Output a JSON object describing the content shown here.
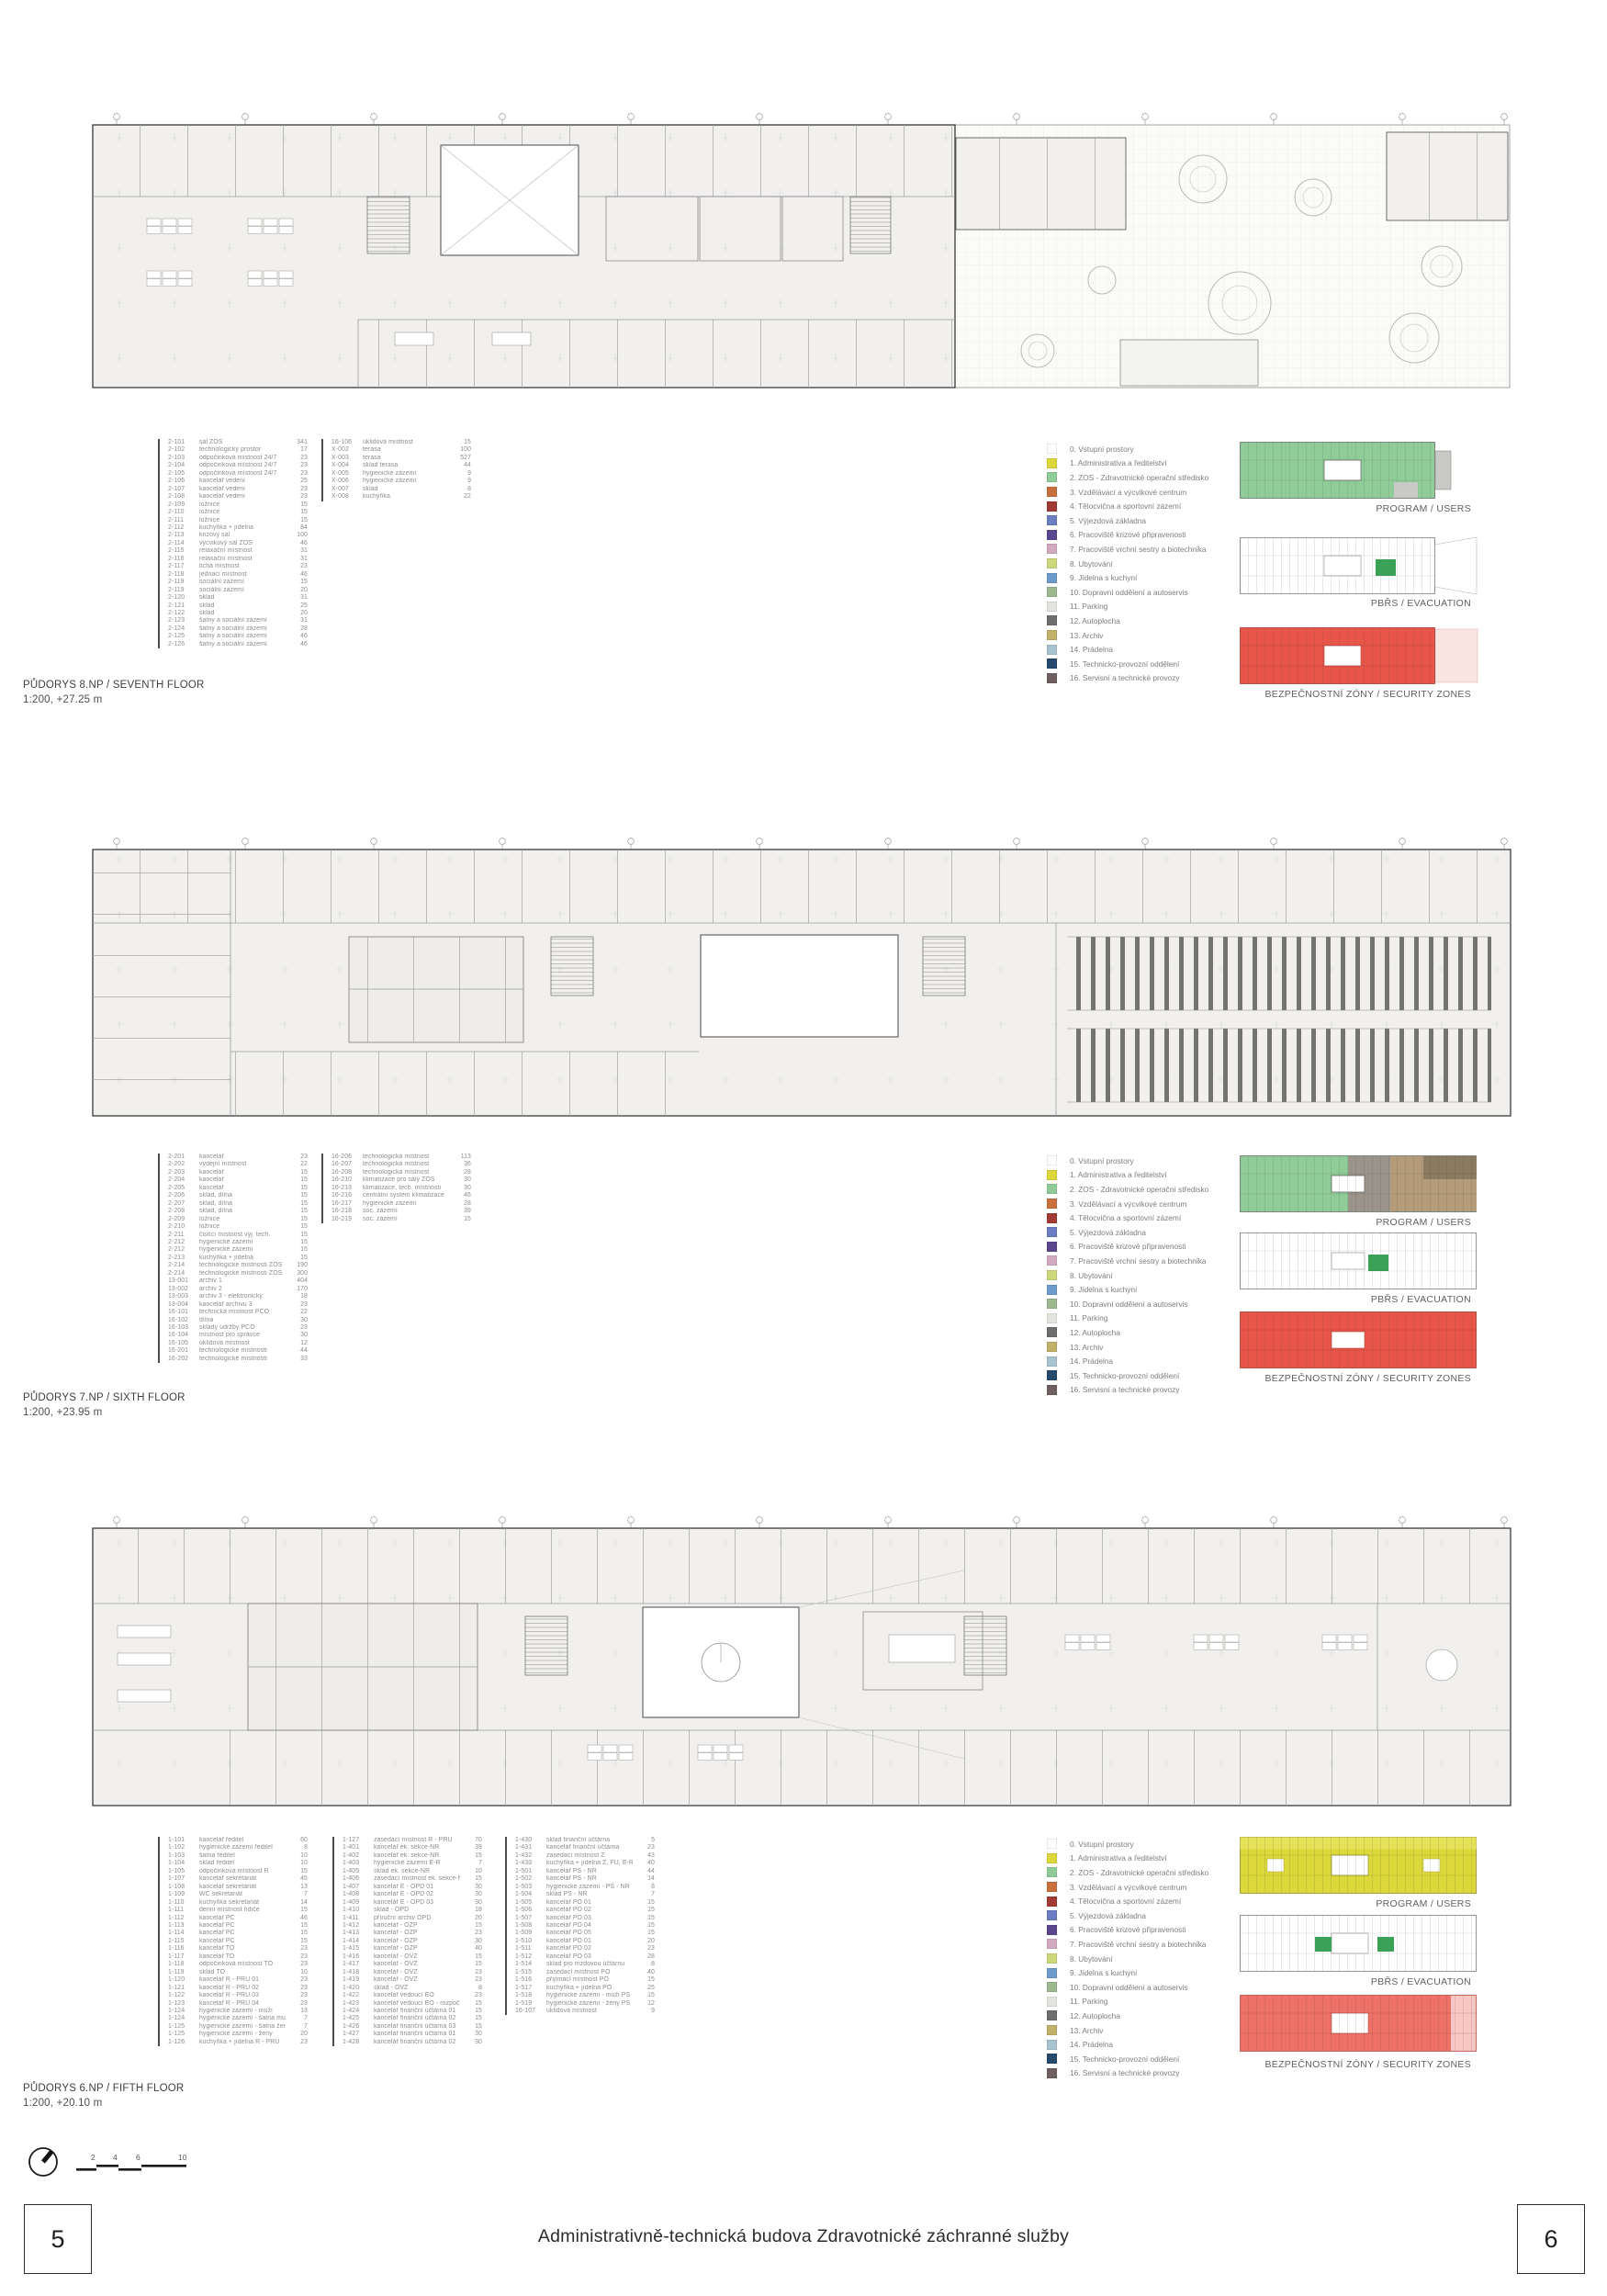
{
  "sheet": {
    "title": "Administrativně-technická budova Zdravotnické záchranné služby",
    "page_left": "5",
    "page_right": "6"
  },
  "diagram_labels": {
    "program": "PROGRAM / USERS",
    "evacuation": "PBŘS / EVACUATION",
    "security": "BEZPEČNOSTNÍ ZÓNY / SECURITY ZONES"
  },
  "scalebar": {
    "ticks": [
      "2",
      "4",
      "6",
      "10"
    ]
  },
  "legend": {
    "items": [
      {
        "label": "0. Vstupní prostory",
        "color": "#ffffff"
      },
      {
        "label": "1. Administrativa a ředitelství",
        "color": "#dcd83b"
      },
      {
        "label": "2. ZOS - Zdravotnické operační středisko",
        "color": "#90cc98"
      },
      {
        "label": "3. Vzdělávací a výcvikové centrum",
        "color": "#c8713d"
      },
      {
        "label": "4. Tělocvična a sportovní zázemí",
        "color": "#a23a36"
      },
      {
        "label": "5. Výjezdová základna",
        "color": "#6b7ec4"
      },
      {
        "label": "6. Pracoviště krizové připravenosti",
        "color": "#59478f"
      },
      {
        "label": "7. Pracoviště vrchní sestry a biotechnika",
        "color": "#d2aabe"
      },
      {
        "label": "8. Ubytování",
        "color": "#cdd77c"
      },
      {
        "label": "9. Jídelna s kuchyní",
        "color": "#6f9bcc"
      },
      {
        "label": "10. Dopravní oddělení a autoservis",
        "color": "#9db88f"
      },
      {
        "label": "11. Parking",
        "color": "#e4e4e0"
      },
      {
        "label": "12. Autoplocha",
        "color": "#6e6e6e"
      },
      {
        "label": "13. Archiv",
        "color": "#c2b169"
      },
      {
        "label": "14. Prádelna",
        "color": "#a7c3cf"
      },
      {
        "label": "15. Technicko-provozní oddělení",
        "color": "#27496d"
      },
      {
        "label": "16. Servisní a technické provozy",
        "color": "#6f5f60"
      }
    ]
  },
  "floors": [
    {
      "id": "8np",
      "title": "PŮDORYS 8.NP / SEVENTH FLOOR",
      "subtitle": "1:200, +27.25 m",
      "rooms_col1": [
        [
          "2-101",
          "sál ZOS",
          "341"
        ],
        [
          "2-102",
          "technologický prostor",
          "17"
        ],
        [
          "2-103",
          "odpočinková místnost 24/7",
          "23"
        ],
        [
          "2-104",
          "odpočinková místnost 24/7",
          "23"
        ],
        [
          "2-105",
          "odpočinková místnost 24/7",
          "23"
        ],
        [
          "2-106",
          "kancelář vedení",
          "25"
        ],
        [
          "2-107",
          "kancelář vedení",
          "23"
        ],
        [
          "2-108",
          "kancelář vedení",
          "23"
        ],
        [
          "2-109",
          "ložnice",
          "15"
        ],
        [
          "2-110",
          "ložnice",
          "15"
        ],
        [
          "2-111",
          "ložnice",
          "15"
        ],
        [
          "2-112",
          "kuchyňka + jídelna",
          "84"
        ],
        [
          "2-113",
          "krizový sál",
          "100"
        ],
        [
          "2-114",
          "výcvikový sál ZOS",
          "46"
        ],
        [
          "2-115",
          "relaxační místnost",
          "31"
        ],
        [
          "2-116",
          "relaxační místnost",
          "31"
        ],
        [
          "2-117",
          "tichá místnost",
          "23"
        ],
        [
          "2-118",
          "jednací místnost",
          "46"
        ],
        [
          "2-119",
          "sociální zázemí",
          "15"
        ],
        [
          "2-119",
          "sociální zázemí",
          "20"
        ],
        [
          "2-120",
          "sklad",
          "31"
        ],
        [
          "2-121",
          "sklad",
          "25"
        ],
        [
          "2-122",
          "sklad",
          "20"
        ],
        [
          "2-123",
          "šatny a sociální zázemí",
          "31"
        ],
        [
          "2-124",
          "šatny a sociální zázemí",
          "28"
        ],
        [
          "2-125",
          "šatny a sociální zázemí",
          "46"
        ],
        [
          "2-126",
          "šatny a sociální zázemí",
          "46"
        ]
      ],
      "rooms_col2": [
        [
          "16-106",
          "úklidová místnost",
          "15"
        ],
        [
          "X-002",
          "terasa",
          "100"
        ],
        [
          "X-003",
          "terasa",
          "527"
        ],
        [
          "X-004",
          "sklad terasa",
          "44"
        ],
        [
          "X-005",
          "hygienické zázemí",
          "9"
        ],
        [
          "X-006",
          "hygienické zázemí",
          "9"
        ],
        [
          "X-007",
          "sklad",
          "8"
        ],
        [
          "X-008",
          "kuchyňka",
          "22"
        ]
      ]
    },
    {
      "id": "7np",
      "title": "PŮDORYS 7.NP / SIXTH FLOOR",
      "subtitle": "1:200, +23.95 m",
      "rooms_col1": [
        [
          "2-201",
          "kancelář",
          "23"
        ],
        [
          "2-202",
          "výdejní místnost",
          "22"
        ],
        [
          "2-203",
          "kancelář",
          "15"
        ],
        [
          "2-204",
          "kancelář",
          "15"
        ],
        [
          "2-205",
          "kancelář",
          "15"
        ],
        [
          "2-206",
          "sklad, dílna",
          "15"
        ],
        [
          "2-207",
          "sklad, dílna",
          "15"
        ],
        [
          "2-208",
          "sklad, dílna",
          "15"
        ],
        [
          "2-209",
          "ložnice",
          "15"
        ],
        [
          "2-210",
          "ložnice",
          "15"
        ],
        [
          "2-211",
          "čistící místnost výj. tech.",
          "15"
        ],
        [
          "2-212",
          "hygienické zázemí",
          "15"
        ],
        [
          "2-212",
          "hygienické zázemí",
          "15"
        ],
        [
          "2-213",
          "kuchyňka + jídelna",
          "15"
        ],
        [
          "2-214",
          "technologické místnosti ZOS",
          "190"
        ],
        [
          "2-214",
          "technologické místnosti ZOS",
          "300"
        ],
        [
          "13-001",
          "archiv 1",
          "404"
        ],
        [
          "13-002",
          "archiv 2",
          "170"
        ],
        [
          "13-003",
          "archiv 3 - elektronický",
          "18"
        ],
        [
          "13-004",
          "kancelář archivu 3",
          "23"
        ],
        [
          "16-101",
          "technická místnost PCO",
          "22"
        ],
        [
          "16-102",
          "dílna",
          "30"
        ],
        [
          "16-103",
          "sklady údržby PCO",
          "23"
        ],
        [
          "16-104",
          "místnost pro správce",
          "30"
        ],
        [
          "16-105",
          "úklidová místnost",
          "12"
        ],
        [
          "16-201",
          "technologické místnosti",
          "44"
        ],
        [
          "16-202",
          "technologické místnosti",
          "33"
        ]
      ],
      "rooms_col2": [
        [
          "16-206",
          "technologická místnost",
          "113"
        ],
        [
          "16-207",
          "technologická místnost",
          "36"
        ],
        [
          "16-208",
          "technologická místnost",
          "28"
        ],
        [
          "16-210",
          "klimatizace pro sály ZOS",
          "30"
        ],
        [
          "16-213",
          "klimatizace, tech. místnosti",
          "30"
        ],
        [
          "16-216",
          "centrální systém klimatizace",
          "46"
        ],
        [
          "16-217",
          "hygienické zázemí",
          "28"
        ],
        [
          "16-218",
          "soc. zázemí",
          "39"
        ],
        [
          "16-219",
          "soc. zázemí",
          "15"
        ]
      ]
    },
    {
      "id": "6np",
      "title": "PŮDORYS 6.NP / FIFTH FLOOR",
      "subtitle": "1:200, +20.10 m",
      "rooms_col1": [
        [
          "1-101",
          "kancelář ředitel",
          "60"
        ],
        [
          "1-102",
          "hygienické zázemí ředitel",
          "8"
        ],
        [
          "1-103",
          "šatna ředitel",
          "10"
        ],
        [
          "1-104",
          "sklad ředitel",
          "10"
        ],
        [
          "1-105",
          "odpočinková místnost Ř",
          "15"
        ],
        [
          "1-107",
          "kancelář sekretariát",
          "45"
        ],
        [
          "1-108",
          "kancelář sekretariát",
          "13"
        ],
        [
          "1-109",
          "WC sekretariát",
          "7"
        ],
        [
          "1-110",
          "kuchyňka sekretariát",
          "14"
        ],
        [
          "1-111",
          "denní místnost řidiče",
          "15"
        ],
        [
          "1-112",
          "kancelář PC",
          "46"
        ],
        [
          "1-113",
          "kancelář PC",
          "15"
        ],
        [
          "1-114",
          "kancelář PC",
          "15"
        ],
        [
          "1-115",
          "kancelář PC",
          "15"
        ],
        [
          "1-116",
          "kancelář TO",
          "23"
        ],
        [
          "1-117",
          "kancelář TO",
          "23"
        ],
        [
          "1-118",
          "odpočinková místnost TO",
          "23"
        ],
        [
          "1-119",
          "sklad TO",
          "10"
        ],
        [
          "1-120",
          "kancelář Ř - PŘU 01",
          "23"
        ],
        [
          "1-121",
          "kancelář Ř - PŘU 02",
          "23"
        ],
        [
          "1-122",
          "kancelář Ř - PŘU 03",
          "23"
        ],
        [
          "1-123",
          "kancelář Ř - PŘU 04",
          "23"
        ],
        [
          "1-124",
          "hygienické zázemí - muži",
          "13"
        ],
        [
          "1-124",
          "hygienické zázemí - šatna muži",
          "7"
        ],
        [
          "1-125",
          "hygienické zázemí - šatna ženy",
          "7"
        ],
        [
          "1-125",
          "hygienické zázemí - ženy",
          "20"
        ],
        [
          "1-126",
          "kuchyňka + jídelna Ř - PŘU",
          "23"
        ]
      ],
      "rooms_col2": [
        [
          "1-127",
          "zasedací místnost Ř - PŘU",
          "70"
        ],
        [
          "1-401",
          "kancelář ek. sekce-NŘ",
          "39"
        ],
        [
          "1-402",
          "kancelář ek. sekce-NŘ",
          "15"
        ],
        [
          "1-403",
          "hygienické zázemí E-Ř",
          "7"
        ],
        [
          "1-405",
          "sklad ek. sekce-NŘ",
          "10"
        ],
        [
          "1-406",
          "zasedací místnost ek. sekce-NŘ",
          "15"
        ],
        [
          "1-407",
          "kancelář E - OPD 01",
          "30"
        ],
        [
          "1-408",
          "kancelář E - OPD 02",
          "30"
        ],
        [
          "1-409",
          "kancelář E - OPD 03",
          "30"
        ],
        [
          "1-410",
          "sklad - OPD",
          "18"
        ],
        [
          "1-411",
          "příruční archiv OPD",
          "20"
        ],
        [
          "1-412",
          "kancelář - OZP",
          "15"
        ],
        [
          "1-413",
          "kancelář - OZP",
          "23"
        ],
        [
          "1-414",
          "kancelář - OZP",
          "30"
        ],
        [
          "1-415",
          "kancelář - OZP",
          "40"
        ],
        [
          "1-416",
          "kancelář - OVZ",
          "15"
        ],
        [
          "1-417",
          "kancelář - OVZ",
          "15"
        ],
        [
          "1-418",
          "kancelář - OVZ",
          "23"
        ],
        [
          "1-419",
          "kancelář - OVZ",
          "23"
        ],
        [
          "1-420",
          "sklad - OVZ",
          "8"
        ],
        [
          "1-422",
          "kancelář vedoucí EO",
          "23"
        ],
        [
          "1-423",
          "kancelář vedoucí EO - rozpočtář",
          "15"
        ],
        [
          "1-424",
          "kancelář finanční účtárna 01",
          "15"
        ],
        [
          "1-425",
          "kancelář finanční účtárna 02",
          "15"
        ],
        [
          "1-426",
          "kancelář finanční účtárna 03",
          "15"
        ],
        [
          "1-427",
          "kancelář finanční účtárna 01",
          "30"
        ],
        [
          "1-428",
          "kancelář finanční účtárna 02",
          "30"
        ]
      ],
      "rooms_col3": [
        [
          "1-430",
          "sklad finanční účtárna",
          "5"
        ],
        [
          "1-431",
          "kancelář finanční účtárna",
          "23"
        ],
        [
          "1-432",
          "zasedací místnost Z",
          "43"
        ],
        [
          "1-433",
          "kuchyňka + jídelna Z, FU, E-Ř",
          "40"
        ],
        [
          "1-501",
          "kancelář PS - NŘ",
          "44"
        ],
        [
          "1-502",
          "kancelář PS - NŘ",
          "14"
        ],
        [
          "1-503",
          "hygienické zázemí - PS - NŘ",
          "8"
        ],
        [
          "1-504",
          "sklad PS - NŘ",
          "7"
        ],
        [
          "1-505",
          "kancelář PO 01",
          "15"
        ],
        [
          "1-506",
          "kancelář PO 02",
          "15"
        ],
        [
          "1-507",
          "kancelář PO 03",
          "15"
        ],
        [
          "1-508",
          "kancelář PO 04",
          "15"
        ],
        [
          "1-509",
          "kancelář PO 05",
          "15"
        ],
        [
          "1-510",
          "kancelář PO 01",
          "20"
        ],
        [
          "1-511",
          "kancelář PO 02",
          "23"
        ],
        [
          "1-512",
          "kancelář PO 03",
          "28"
        ],
        [
          "1-514",
          "sklad pro mzdovou účtárnu",
          "8"
        ],
        [
          "1-515",
          "zasedací místnost PO",
          "40"
        ],
        [
          "1-516",
          "přijímací místnost PO",
          "15"
        ],
        [
          "1-517",
          "kuchyňka + jídelna PO",
          "25"
        ],
        [
          "1-518",
          "hygienické zázemí - muži PS",
          "15"
        ],
        [
          "1-519",
          "hygienické zázemí - ženy PS",
          "12"
        ],
        [
          "16-107",
          "úklidová místnost",
          "9"
        ]
      ]
    }
  ]
}
